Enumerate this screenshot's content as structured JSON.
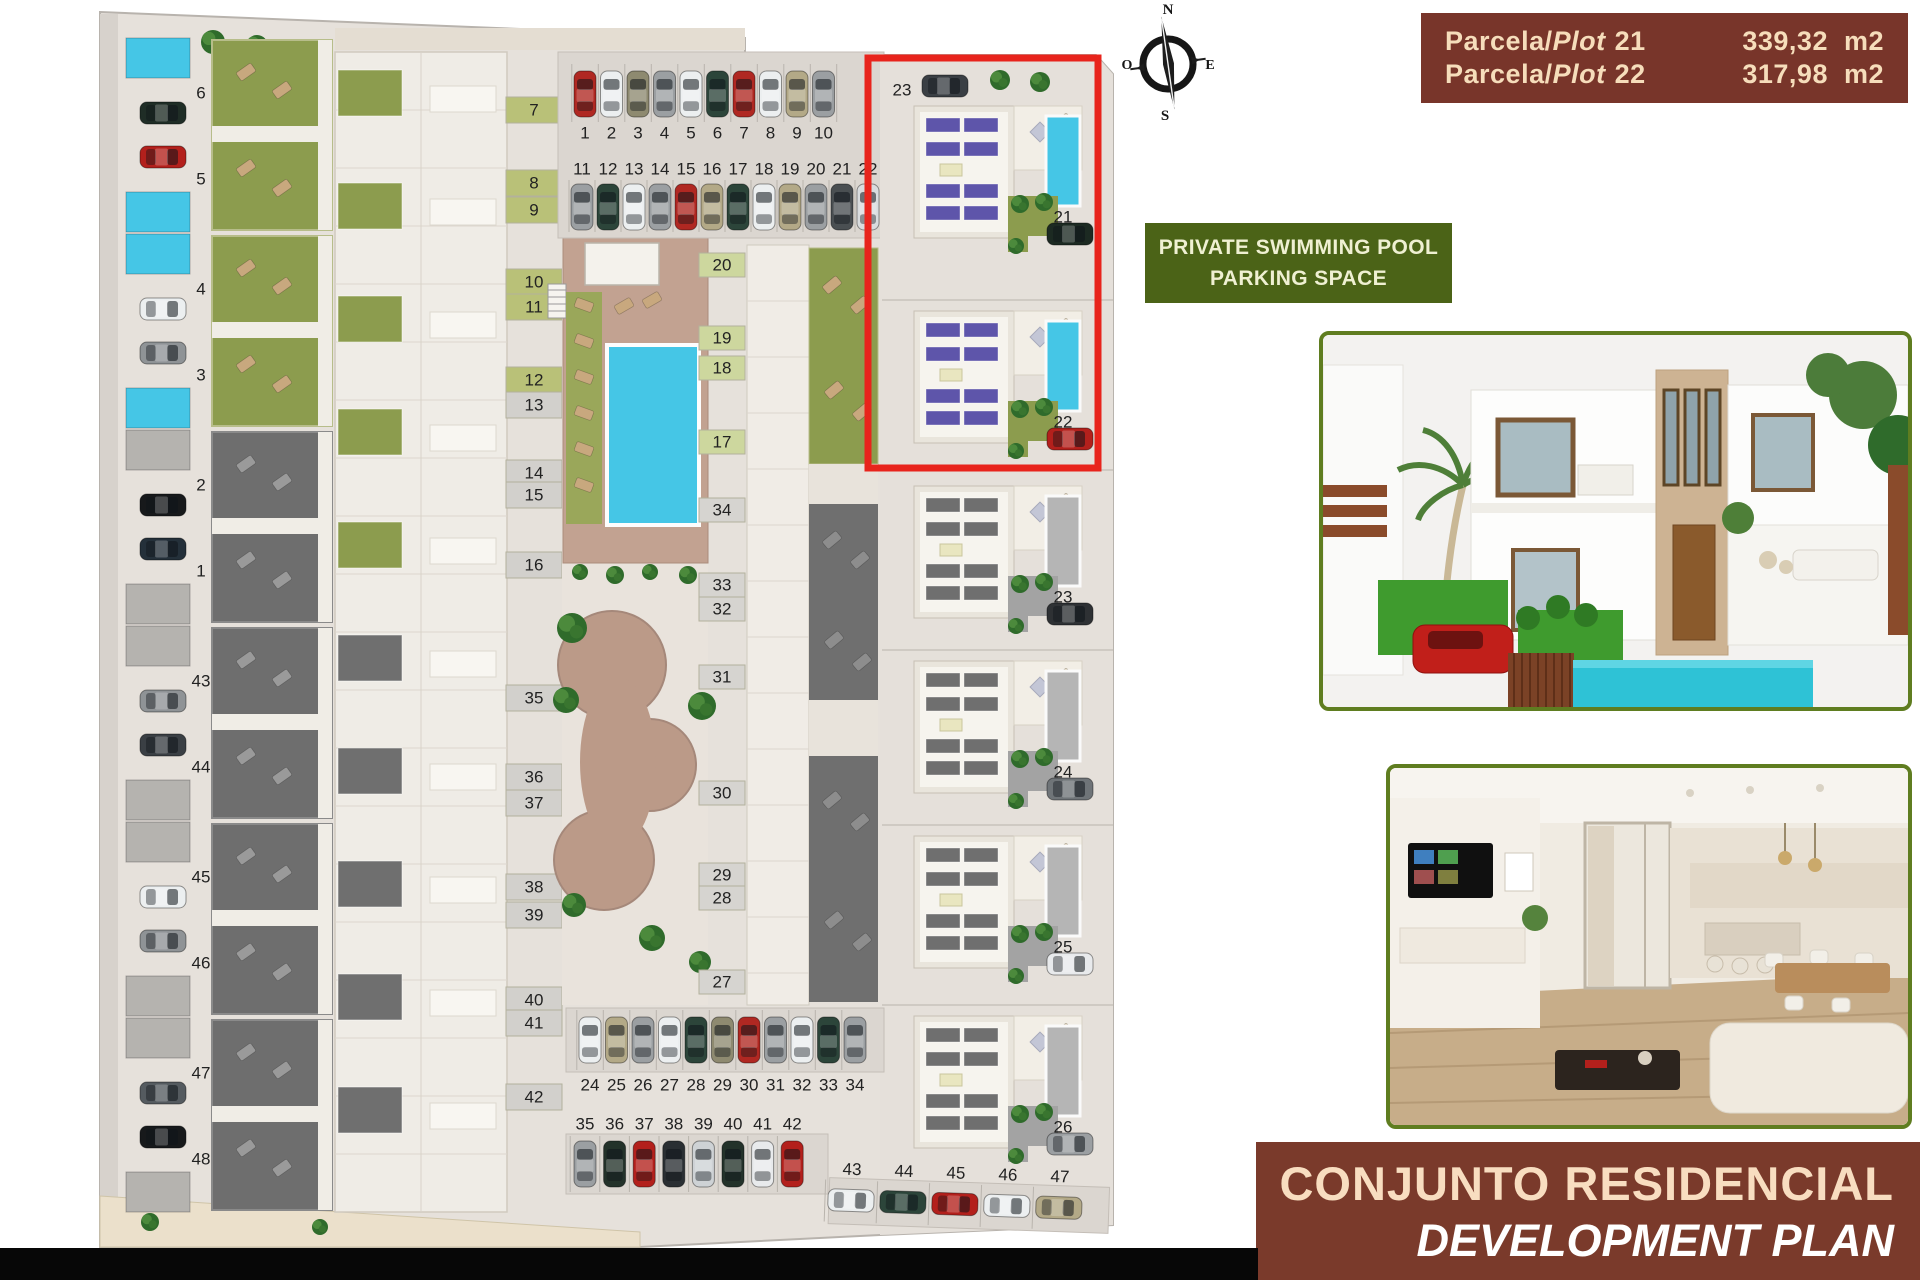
{
  "compass": {
    "north": "N",
    "south": "S",
    "east": "E",
    "west": "O"
  },
  "plot_info": {
    "bg": "#78352a",
    "text_color": "#f6ddbb",
    "rows": [
      {
        "prefix": "Parcela/",
        "name": "Plot",
        "number": "21",
        "area": "339,32",
        "unit": "m2"
      },
      {
        "prefix": "Parcela/",
        "name": "Plot",
        "number": "22",
        "area": "317,98",
        "unit": "m2"
      }
    ]
  },
  "feature_box": {
    "bg": "#4b6317",
    "text_color": "#eff0d2",
    "line1": "PRIVATE SWIMMING POOL",
    "line2": "PARKING SPACE"
  },
  "banner": {
    "bg": "#7a3a2b",
    "line1": "CONJUNTO RESIDENCIAL",
    "line2": "DEVELOPMENT PLAN",
    "line1_color": "#f8ddc0",
    "line2_color": "#ffffff"
  },
  "site_plan": {
    "highlight_color": "#e8241c",
    "palette": {
      "plan_bg": "#e6e1db",
      "edge": "#b8b3ad",
      "pool_blue": "#45c6e6",
      "pool_gray": "#b5b3af",
      "garden_green": "#8c9c4e",
      "garden_chip_green": "#b9c178",
      "garden_chip_gray": "#d2d0cc",
      "roof_gray": "#6f6f6f",
      "panel_purple": "#5e55aa",
      "panel_gray": "#6f6f6f",
      "brick": "#bb9a88",
      "deck": "#c2a291",
      "tree": "#2f6b2b",
      "lounger": "#c8a87e",
      "number_color": "#222222"
    },
    "top_parking_rows": [
      {
        "numbers": [
          "1",
          "2",
          "3",
          "4",
          "5",
          "6",
          "7",
          "8",
          "9",
          "10"
        ],
        "car_colors": [
          "#b02822",
          "#eceff0",
          "#8e8a70",
          "#9b9fa2",
          "#eceff0",
          "#2c453a",
          "#b02822",
          "#eceff0",
          "#b3a987",
          "#9b9fa2"
        ]
      },
      {
        "numbers": [
          "11",
          "12",
          "13",
          "14",
          "15",
          "16",
          "17",
          "18",
          "19",
          "20",
          "21",
          "22"
        ],
        "car_colors": [
          "#9b9fa2",
          "#2c453a",
          "#eceff0",
          "#9b9fa2",
          "#b02822",
          "#b3a987",
          "#2c453a",
          "#eceff0",
          "#b3a987",
          "#9b9fa2",
          "#4a4f52",
          "#d9dcde"
        ]
      }
    ],
    "bottom_parking_rows": [
      {
        "numbers": [
          "24",
          "25",
          "26",
          "27",
          "28",
          "29",
          "30",
          "31",
          "32",
          "33",
          "34"
        ],
        "car_colors": [
          "#eceff0",
          "#b3a987",
          "#9b9fa2",
          "#eceff0",
          "#2c453a",
          "#8e8a70",
          "#b02822",
          "#9b9fa2",
          "#eceff0",
          "#2c453a",
          "#9b9fa2"
        ]
      },
      {
        "numbers": [
          "35",
          "36",
          "37",
          "38",
          "39",
          "40",
          "41",
          "42"
        ],
        "car_colors": [
          "#9b9fa2",
          "#23322a",
          "#b3201c",
          "#2a2f33",
          "#ced2d5",
          "#23322a",
          "#e8eaec",
          "#b3201c"
        ]
      }
    ],
    "corner_parking": {
      "numbers": [
        "43",
        "44",
        "45",
        "46",
        "47"
      ],
      "car_colors": [
        "#eceff0",
        "#2c453a",
        "#b3201c",
        "#eceff0",
        "#b3a987"
      ]
    },
    "left_plots": [
      {
        "id": "6",
        "car": "#1f2d26",
        "pool": "blue"
      },
      {
        "id": "5",
        "car": "#b3201c",
        "pool": "blue"
      },
      {
        "id": "4",
        "car": "#eceff0",
        "pool": "blue"
      },
      {
        "id": "3",
        "car": "#8f9396",
        "pool": "blue"
      },
      {
        "id": "2",
        "car": "#17191b",
        "pool": "gray"
      },
      {
        "id": "1",
        "car": "#24303a",
        "pool": "gray"
      },
      {
        "id": "43",
        "car": "#8f9396",
        "pool": "gray"
      },
      {
        "id": "44",
        "car": "#3a3f44",
        "pool": "gray"
      },
      {
        "id": "45",
        "car": "#eceff0",
        "pool": "gray"
      },
      {
        "id": "46",
        "car": "#8f9396",
        "pool": "gray"
      },
      {
        "id": "47",
        "car": "#555b60",
        "pool": "gray"
      },
      {
        "id": "48",
        "car": "#17191b",
        "pool": "gray"
      }
    ],
    "rowhouse_labels": {
      "green": [
        "7",
        "8",
        "9",
        "10",
        "11",
        "12"
      ],
      "gray": [
        "13",
        "14",
        "15",
        "16"
      ],
      "lower": [
        "35",
        "36",
        "37",
        "38",
        "39",
        "40",
        "41",
        "42"
      ]
    },
    "midcol_labels": {
      "green": [
        "20",
        "19",
        "18",
        "17"
      ],
      "gray": [
        "34",
        "33",
        "32",
        "31",
        "30",
        "29",
        "28",
        "27"
      ]
    },
    "villas": [
      {
        "id": "21",
        "style": "color",
        "car": "#1c2a22"
      },
      {
        "id": "22",
        "style": "color",
        "car": "#b3201c"
      },
      {
        "id": "23",
        "style": "gray",
        "car": "#2e3134"
      },
      {
        "id": "24",
        "style": "gray",
        "car": "#6f7478"
      },
      {
        "id": "25",
        "style": "gray",
        "car": "#e8eaec"
      },
      {
        "id": "26",
        "style": "gray",
        "car": "#9b9fa2"
      }
    ],
    "villa_parking_label": "23"
  }
}
